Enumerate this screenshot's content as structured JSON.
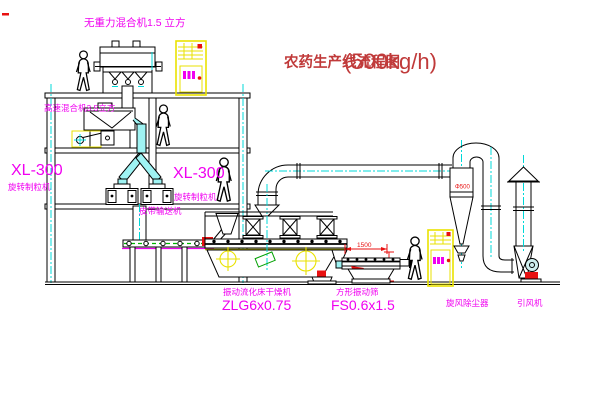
{
  "title": {
    "name_cn": "农药生产线流程图",
    "capacity": "(500kg/h)"
  },
  "equipment": {
    "gravity_mixer": {
      "label": "无重力混合机1.5 立方"
    },
    "high_speed_mixer": {
      "label": "高速混合机3.5立方"
    },
    "granulator_left": {
      "model": "XL-300",
      "name": "旋转制粒机"
    },
    "granulator_right": {
      "model": "XL-300",
      "name": "旋转制粒机"
    },
    "belt_conveyor": {
      "label": "皮带输送机"
    },
    "fluid_bed_dryer": {
      "name": "振动流化床干燥机",
      "model": "ZLG6x0.75"
    },
    "vibrating_sieve": {
      "name": "方形振动筛",
      "model": "FS0.6x1.5"
    },
    "cyclone": {
      "name": "旋风除尘器",
      "diameter": "Φ500"
    },
    "induced_draft_fan": {
      "name": "引风机"
    }
  },
  "dimensions": {
    "sieve_length": "1500",
    "sieve_height": "341"
  },
  "colors": {
    "label_magenta": "#f000f0",
    "title_red": "#c03a3a",
    "accent_red": "#e81111",
    "centerline_cyan": "#00d8d8",
    "cabinet_yellow": "#e9e200",
    "accent_green": "#00a000",
    "line_black": "#000000"
  }
}
